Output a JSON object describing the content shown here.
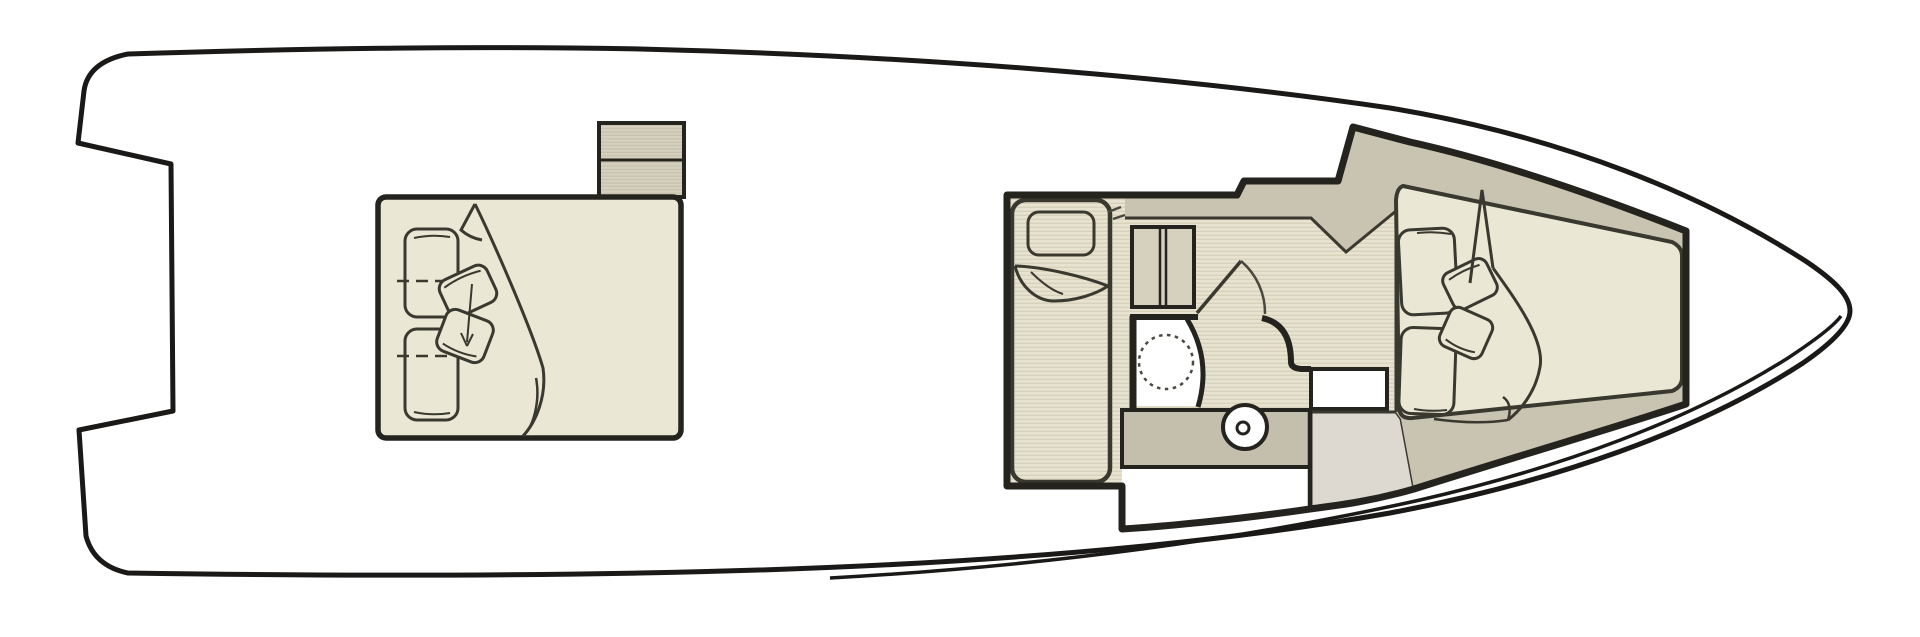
{
  "meta": {
    "title": "Yacht lower deck floor plan",
    "description": "Top-down line drawing of a motor yacht deck: midship double-bed cabin, companionway steps, forward guest berth, shower room with vanity sink, and bow V-berth with pillows"
  },
  "colors": {
    "background": "#ffffff",
    "hull-line": "#1a1917",
    "wall-line": "#24231e",
    "furniture-line": "#3a392f",
    "thin-line": "#4a4940",
    "cream": "#eae7d5",
    "floor-base": "#e7e3d0",
    "floor-stripe": "#d8d2bc",
    "band-tan": "#c9c3b2",
    "vanity-tan": "#c4beac",
    "light-grey": "#ded9d0",
    "steps-base": "#d6d0bf",
    "steps-stripe": "#c6c0ad",
    "white": "#ffffff"
  },
  "areas": {
    "hull": {
      "label": "Hull outline"
    },
    "midship_cabin": {
      "label": "Midship cabin with double bed, pillows and folded duvet"
    },
    "steps": {
      "label": "Companionway steps"
    },
    "guest_berth": {
      "label": "Guest single berth with pillow and folded blanket"
    },
    "wardrobe": {
      "label": "Two-door wardrobe cabinet"
    },
    "cabin_door": {
      "label": "Cabin door with swing arc"
    },
    "head": {
      "label": "Head / shower room with shower tray"
    },
    "vanity": {
      "label": "Vanity counter with round sink"
    },
    "bow_cabin": {
      "label": "Bow V-berth with back cushions, pillows and duvet"
    }
  }
}
